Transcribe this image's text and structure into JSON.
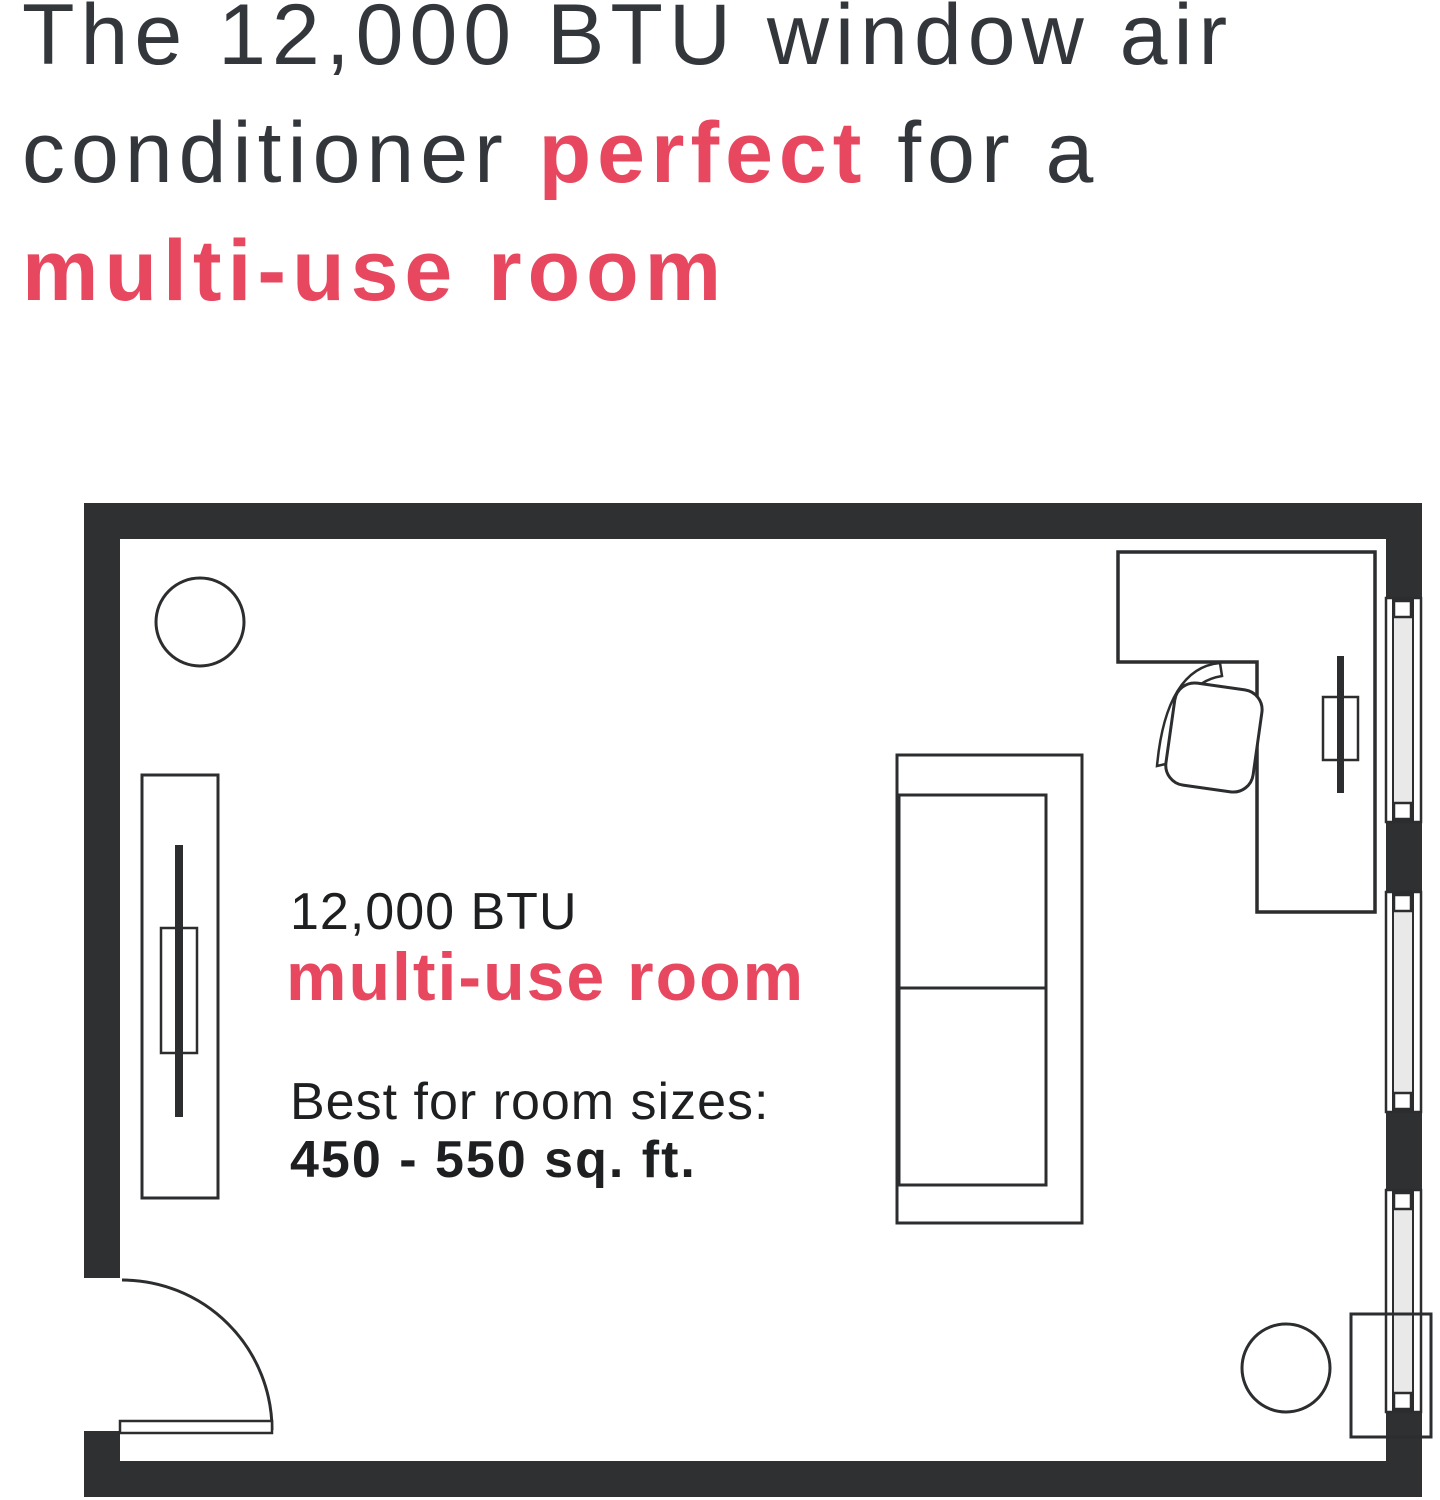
{
  "headline": {
    "line1": "The 12,000 BTU window air",
    "line2_pre": "conditioner ",
    "line2_accent": "perfect",
    "line2_post": " for a",
    "line3": "multi-use room"
  },
  "plan_label": {
    "btu": "12,000 BTU",
    "room_type": "multi-use room",
    "best_for": "Best for room sizes:",
    "size_range": "450 - 550 sq. ft."
  },
  "colors": {
    "accent": "#e7475f",
    "wall": "#2f3032",
    "line": "#2b2d2f",
    "ink": "#1d1f21",
    "ink-soft": "#33373c",
    "glass": "#e9e9e9"
  }
}
